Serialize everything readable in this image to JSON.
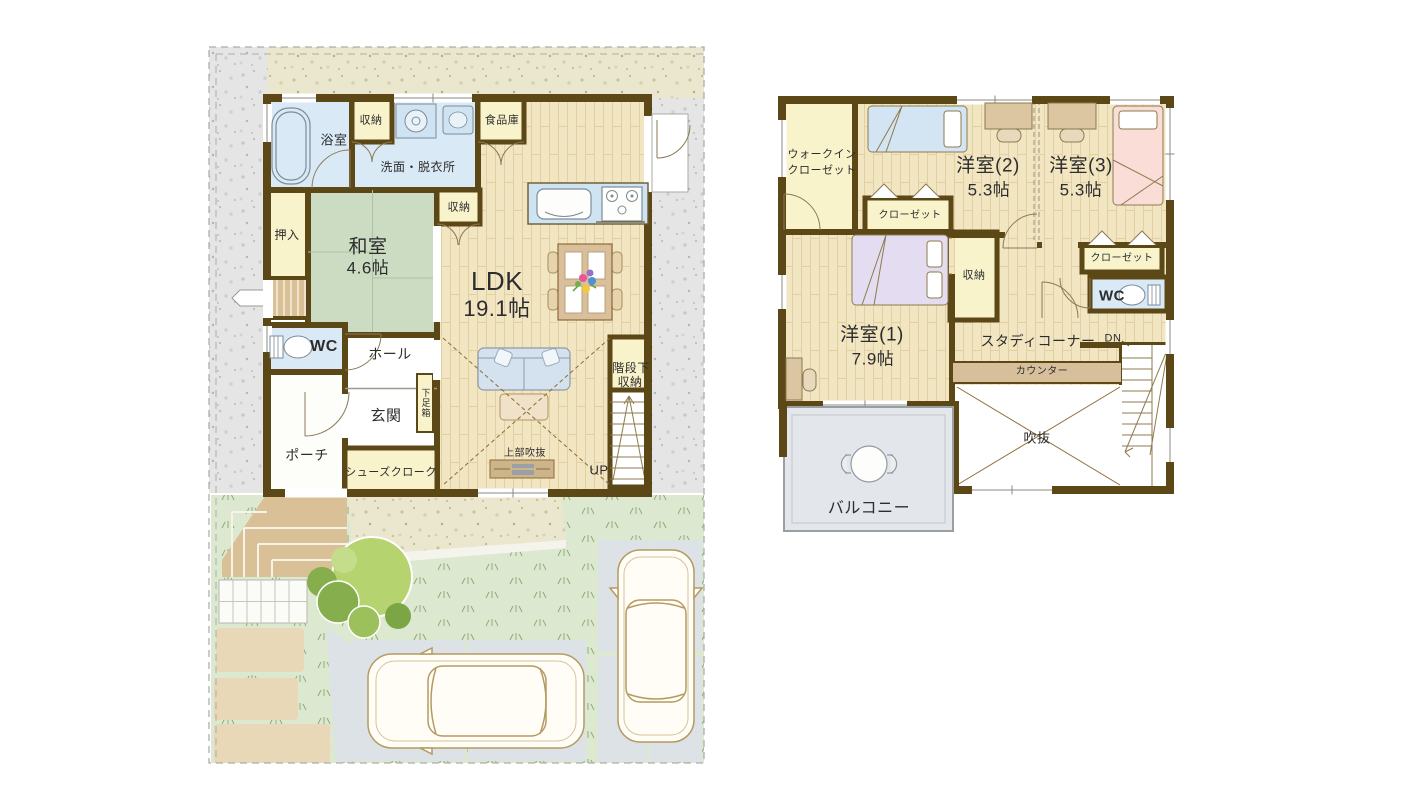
{
  "palette": {
    "wall": "#5c4716",
    "wood_floor": "#f2e5c2",
    "tatami": "#cbdcc2",
    "water_room": "#d9eaf6",
    "storage_room": "#f9f3cc",
    "gray_gravel": "#e5e5e6",
    "beige_gravel": "#eae7ce",
    "grass": "#dce8cf",
    "concrete": "#dde2e6",
    "paving": "#e9d8b8",
    "steps_tan": "#d9c096",
    "balcony_floor": "#e3e6ea",
    "text": "#2d2d2d"
  },
  "floor1": {
    "labels": {
      "bathroom": "浴室",
      "storage_top": "収納",
      "washroom": "洗面・脱衣所",
      "pantry": "食品庫",
      "oshiire": "押入",
      "washitsu_name": "和室",
      "washitsu_size": "4.6帖",
      "storage_mid": "収納",
      "ldk_name": "LDK",
      "ldk_size": "19.1帖",
      "wc": "WC",
      "hall": "ホール",
      "genkan": "玄関",
      "getabako": "下足箱",
      "porch": "ポーチ",
      "shoes_cloak": "シューズクローク",
      "upper_void": "上部吹抜",
      "under_stairs_line1": "階段下",
      "under_stairs_line2": "収納",
      "up": "UP"
    }
  },
  "floor2": {
    "labels": {
      "wic_line1": "ウォークイン",
      "wic_line2": "クローゼット",
      "room2_name": "洋室(2)",
      "room2_size": "5.3帖",
      "room3_name": "洋室(3)",
      "room3_size": "5.3帖",
      "closet_room2": "クローゼット",
      "storage": "収納",
      "closet_room3": "クローゼット",
      "wc": "WC",
      "room1_name": "洋室(1)",
      "room1_size": "7.9帖",
      "study": "スタディコーナー",
      "dn": "DN",
      "counter": "カウンター",
      "void": "吹抜",
      "balcony": "バルコニー"
    }
  }
}
